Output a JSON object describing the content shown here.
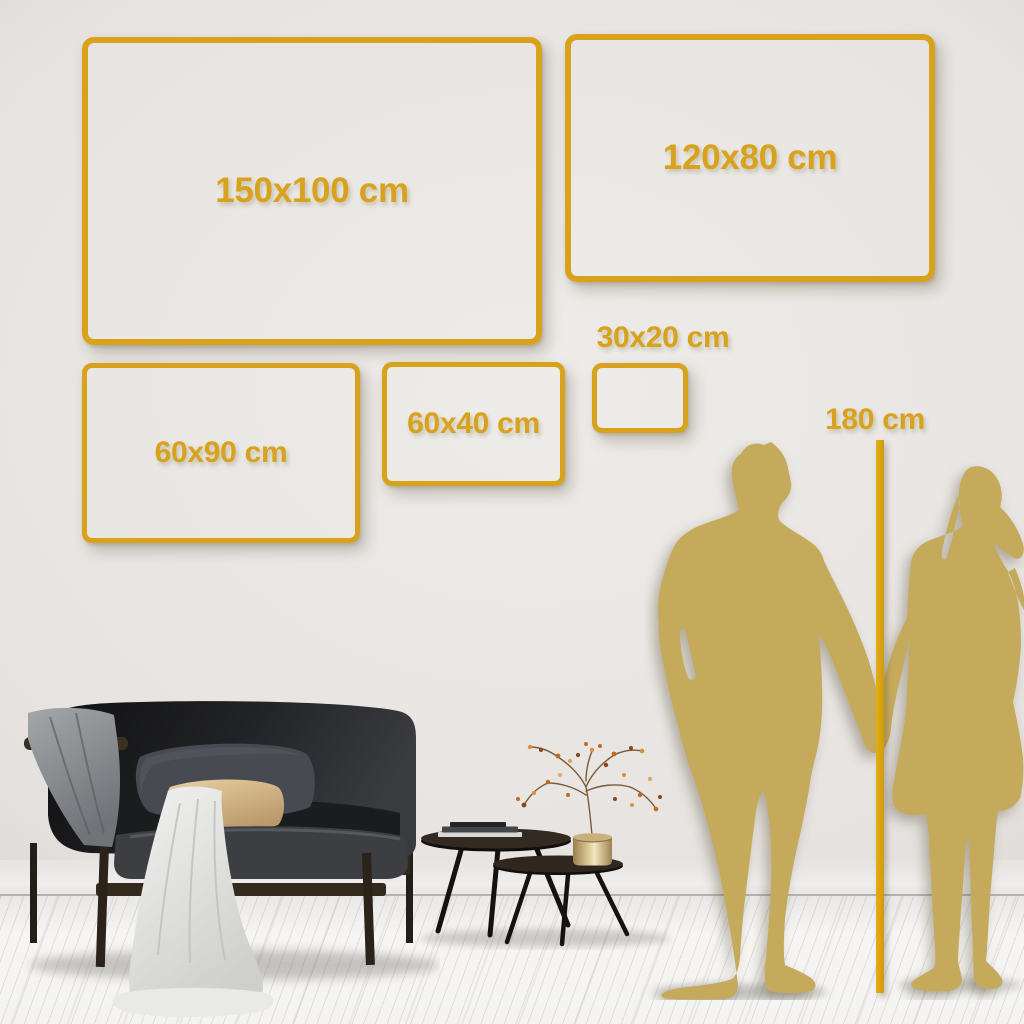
{
  "scene": {
    "description": "Wall art size guide mockup: gold frame outlines on a wall with furniture and a couple silhouette for scale",
    "unit": "cm"
  },
  "sizes": [
    {
      "label": "150x100 cm",
      "width_cm": 150,
      "height_cm": 100
    },
    {
      "label": "120x80 cm",
      "width_cm": 120,
      "height_cm": 80
    },
    {
      "label": "60x90 cm",
      "width_cm": 60,
      "height_cm": 90
    },
    {
      "label": "60x40 cm",
      "width_cm": 60,
      "height_cm": 40
    },
    {
      "label": "30x20 cm",
      "width_cm": 30,
      "height_cm": 20
    }
  ],
  "height_marker": {
    "label": "180 cm",
    "height_cm": 180
  },
  "colors": {
    "frame_gold": "#d8a21c",
    "silhouette_gold": "#c6aa5b",
    "wall": "#e3e0dd",
    "floor": "#f4f3f1"
  },
  "illustrations": {
    "couple": "man-and-woman-holding-hands-silhouette",
    "sofa": "dark-velvet-sofa-with-pillows-and-throw-blankets",
    "coffee_tables": "nesting-coffee-tables-with-books-and-brass-vase-with-dried-branch"
  }
}
